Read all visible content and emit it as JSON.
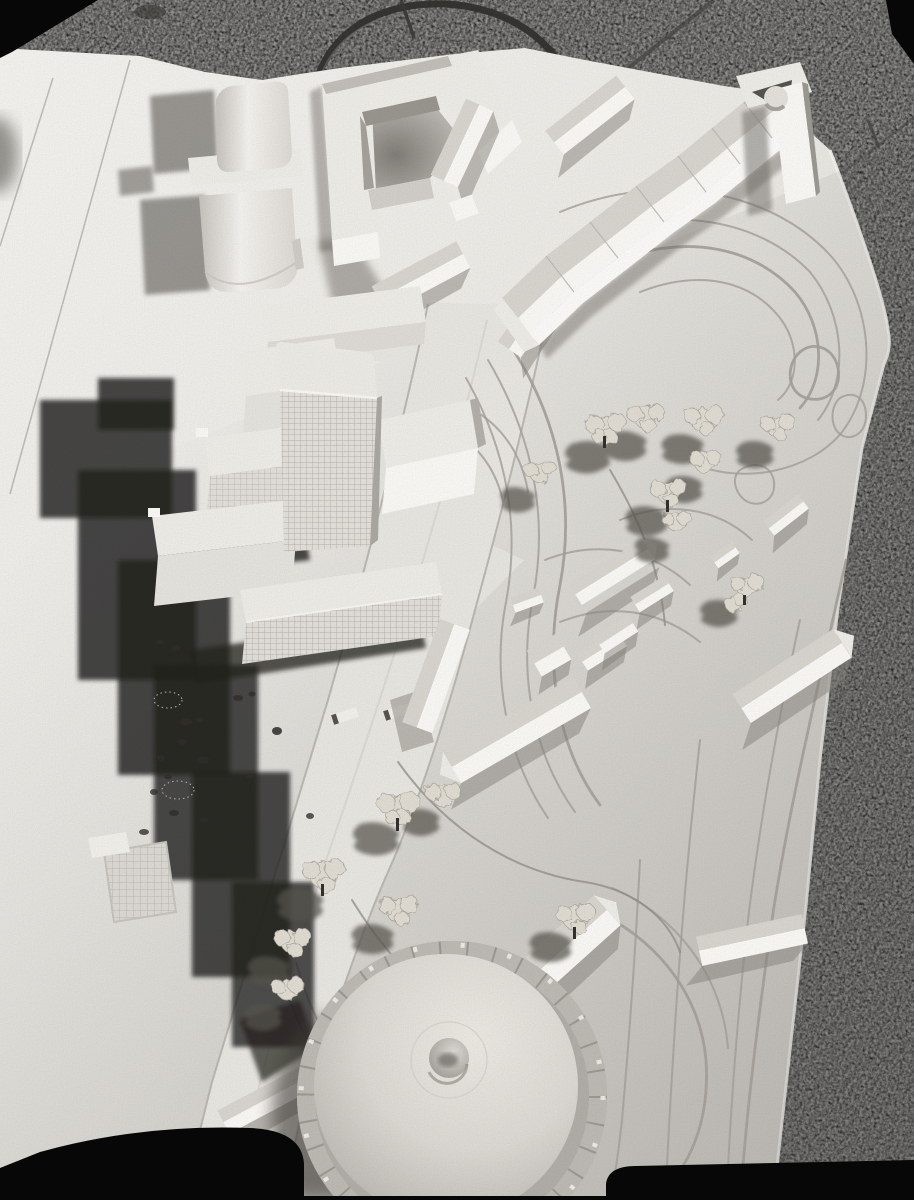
{
  "image": {
    "kind": "black-and-white photograph",
    "subject": "architectural scale model seen from above on speckled ground",
    "orientation": "portrait"
  },
  "palette": {
    "film_black": "#070707",
    "ground_speckle_dark": "#53514d",
    "ground_seam": "#45433f",
    "board_white": "#f4f2ee",
    "board_mid": "#eceae5",
    "board_dim": "#d7d4ce",
    "road_grey": "#e8e6e1",
    "curb_line": "#b6b3ad",
    "building_top": "#eeece7",
    "building_sunlit": "#f9f8f5",
    "building_shade": "#a7a49e",
    "window_grid": "#a8a5a0",
    "contour_line": "#a49f98",
    "shadow_dark": "#22211e",
    "shadow_soft": "#6e6b65",
    "tree_foliage": "#e0dcd2",
    "tree_trunk": "#33312d",
    "dome_light": "#ece9e3",
    "dome_dark": "#aaa7a1",
    "drum_panel": "#bdbab4",
    "wire_handle": "#33312e"
  },
  "scene": {
    "elements": [
      "granite-ground",
      "wire-handle",
      "model-board",
      "board-seams",
      "barrel-roof-buildings",
      "courtyard-building",
      "terrace-gable-blocks",
      "crescent-terrace-row",
      "corner-tower",
      "highrise-tower",
      "stepped-slab-blocks",
      "gridded-slab",
      "cast-shadows",
      "curved-road",
      "playground",
      "sports-court",
      "park-trees",
      "terrain-contours",
      "detached-houses",
      "round-hall-dome",
      "film-border"
    ]
  }
}
